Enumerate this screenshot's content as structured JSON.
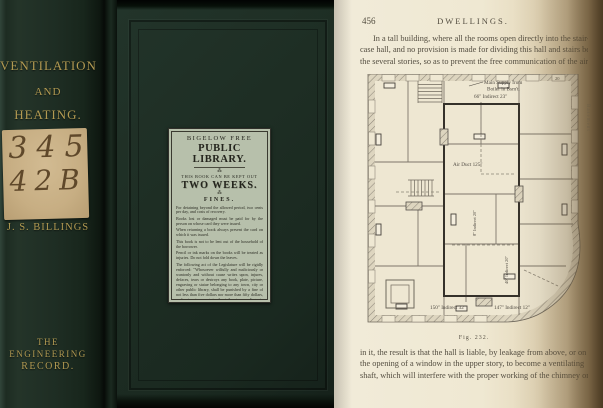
{
  "photo": {
    "book": {
      "spine": {
        "title_lines": [
          "VENTILATION",
          "AND",
          "HEATING."
        ],
        "call_number": {
          "line1": "345",
          "line2": "42B"
        },
        "author": "J. S. BILLINGS",
        "publisher_lines": [
          "THE",
          "ENGINEERING",
          "RECORD."
        ]
      },
      "cover_label": {
        "library_line1": "BIGELOW FREE",
        "library_line2": "PUBLIC LIBRARY.",
        "ornament": "⁂",
        "keep_out_line": "THIS BOOK CAN BE KEPT OUT",
        "period": "TWO WEEKS.",
        "fines_heading": "FINES.",
        "fines_rules": [
          "For detaining beyond the allowed period, two cents per day, and costs of recovery.",
          "Books lost or damaged must be paid for by the person on whose card they were issued.",
          "When returning a book always present the card on which it was issued.",
          "This book is not to be lent out of the household of the borrower.",
          "Pencil or ink marks on the books will be treated as injuries. Do not fold down the leaves."
        ],
        "statute": "The following act of the Legislature will be rigidly enforced: \"Whosoever wilfully and maliciously or wantonly and without cause writes upon, injures, defaces, tears or destroys any book, plate, picture, engraving or statue belonging to any town, city or other public library, shall be punished by a fine of not less than five dollars nor more than fifty dollars, or by imprisonment in the jail not exceeding six months, for every such offence.\"",
        "print_code": "[1000. Nov. '92.]"
      }
    },
    "page": {
      "number": "456",
      "header": "DWELLINGS.",
      "paragraph_top_lines": [
        "In a tall building, where all the rooms open directly into the stair-",
        "case hall, and no provision is made for dividing this hall and stairs between",
        "the several stories, so as to prevent the free communication of the air of"
      ],
      "figure": {
        "caption": "Fig. 232.",
        "annotations": {
          "main_supply_line1": "Main Supply from",
          "main_supply_line2": "Boiler in Bsm't.",
          "indirect_top": "66\" Indirect 23\"",
          "air_duct": "Air Duct 125\"",
          "indirect_bottom_left": "150\" Indirect 32\"",
          "indirect_bottom_right": "147\" Indirect 12\"",
          "register_number": "20",
          "basement": "Basement",
          "rotated_left": "8\" Indirect 20\"",
          "rotated_right": "40\" Indirect 20\""
        }
      },
      "paragraph_bottom_lines": [
        "in it, the result is that the hall is liable, by leakage from above, or on",
        "the opening of a window in the upper story, to become a ventilating",
        "shaft, which will interfere with the proper working of the chimney or"
      ]
    }
  },
  "colors": {
    "cover_green": "#1f2e24",
    "gold_lettering": "#b29a52",
    "call_label_tan": "#c7ae83",
    "library_label": "#b7c0ab",
    "page_cream": "#efe8d2",
    "ink": "#534d40"
  }
}
